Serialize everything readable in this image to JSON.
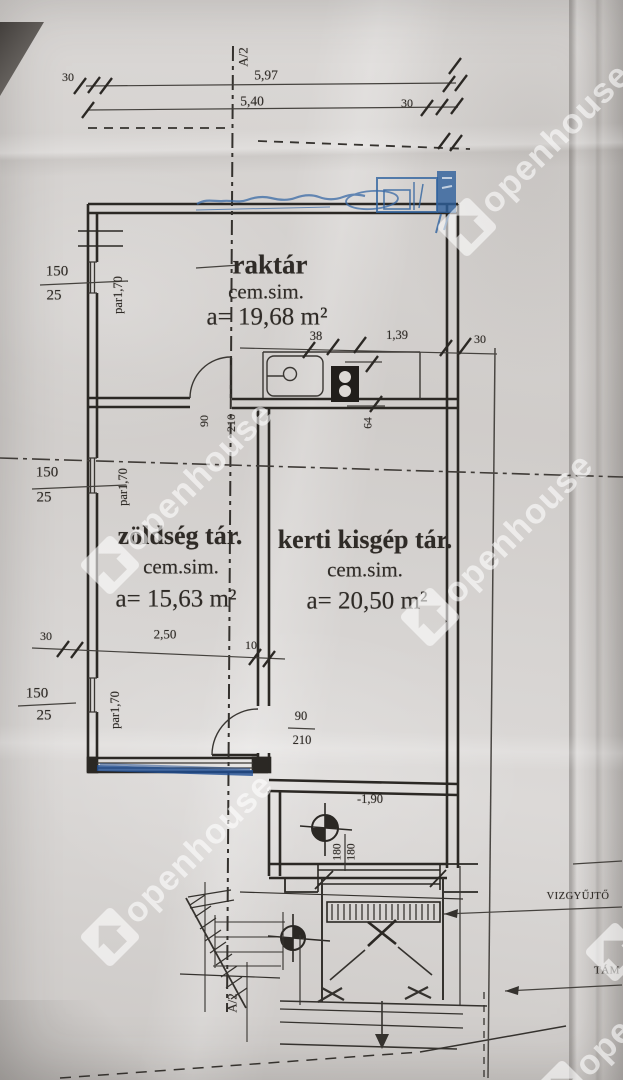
{
  "watermark": {
    "brand": "openhouse"
  },
  "section": {
    "marker_top": "A/2",
    "marker_bottom": "A/2"
  },
  "top_dims": {
    "offset_left": "30",
    "total": "5,97",
    "inner": "5,40",
    "offset_right": "30"
  },
  "rooms": {
    "raktar": {
      "name": "raktár",
      "finish": "cem.sim.",
      "area": "a= 19,68 m²"
    },
    "zoldseg": {
      "name": "zöldség tár.",
      "finish": "cem.sim.",
      "area": "a= 15,63 m²"
    },
    "kerti": {
      "name": "kerti kisgép tár.",
      "finish": "cem.sim.",
      "area": "a= 20,50 m²"
    }
  },
  "openings": {
    "window_size": "150",
    "window_parapet": "25",
    "window_note": "par1,70",
    "door_width": "90",
    "door_height": "210"
  },
  "counter_dims": {
    "d1": "38",
    "d2": "1,39",
    "d3": "30",
    "d4": "64"
  },
  "lower_dims": {
    "d1": "30",
    "d2": "2,50",
    "d3": "10"
  },
  "pit": {
    "level": "-1,90",
    "d1": "180",
    "d2": "180"
  },
  "callouts": {
    "water_collector": "VIZGYŰJTŐ",
    "retaining_wall": "TÁM"
  }
}
